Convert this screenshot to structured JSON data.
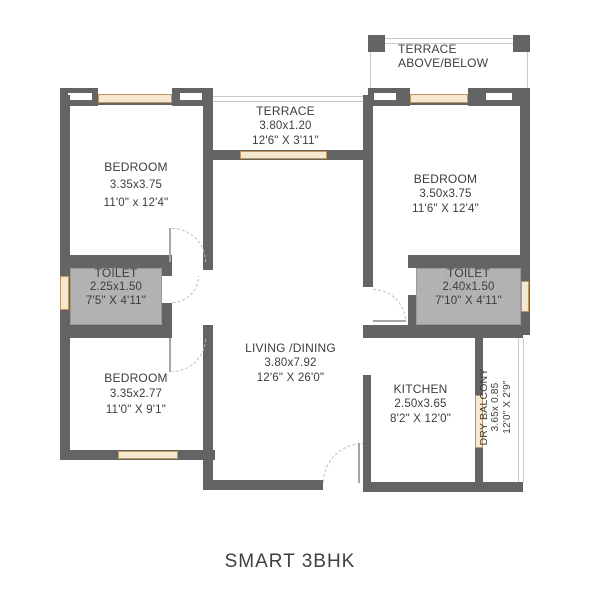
{
  "title": "SMART 3BHK",
  "colors": {
    "wall": "#646464",
    "toilet_floor": "#b2b2b2",
    "window_fill": "#f5e8d0",
    "window_border": "#bf9560",
    "text": "#3d3d3d"
  },
  "rooms": {
    "terrace_top": {
      "name": "TERRACE",
      "sub": "ABOVE/BELOW"
    },
    "terrace": {
      "name": "TERRACE",
      "metric": "3.80x1.20",
      "imperial": "12'6\" X 3'11\""
    },
    "bedroom_top_left": {
      "name": "BEDROOM",
      "metric": "3.35x3.75",
      "imperial": "11'0\" x 12'4\""
    },
    "bedroom_top_right": {
      "name": "BEDROOM",
      "metric": "3.50x3.75",
      "imperial": "11'6\" X 12'4\""
    },
    "toilet_left": {
      "name": "TOILET",
      "metric": "2.25x1.50",
      "imperial": "7'5\" X 4'11\""
    },
    "toilet_right": {
      "name": "TOILET",
      "metric": "2.40x1.50",
      "imperial": "7'10\" X 4'11\""
    },
    "bedroom_bottom_left": {
      "name": "BEDROOM",
      "metric": "3.35x2.77",
      "imperial": "11'0\" X 9'1\""
    },
    "living_dining": {
      "name": "LIVING /DINING",
      "metric": "3.80x7.92",
      "imperial": "12'6\" X 26'0\""
    },
    "kitchen": {
      "name": "KITCHEN",
      "metric": "2.50x3.65",
      "imperial": "8'2\" X 12'0\""
    },
    "dry_balcony": {
      "name": "DRY BALCONY",
      "metric": "3.65x 0.85",
      "imperial": "12'0\" X 2'9\""
    }
  }
}
